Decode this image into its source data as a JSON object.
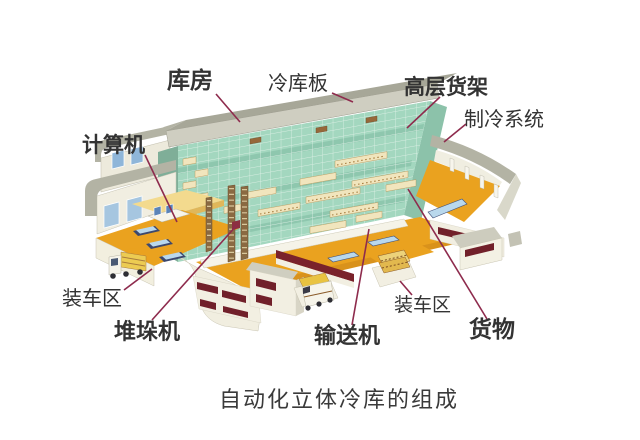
{
  "diagram": {
    "title": "自动化立体冷库的组成",
    "labels": {
      "storeroom": "库房",
      "cold_storage_panel": "冷库板",
      "high_rise_rack": "高层货架",
      "refrigeration_system": "制冷系统",
      "computer": "计算机",
      "loading_area_left": "装车区",
      "loading_area_right": "装车区",
      "stacker_crane": "堆垛机",
      "conveyor": "输送机",
      "goods": "货物"
    },
    "colors": {
      "background": "#ffffff",
      "leader_line": "#8e2b4d",
      "floor_orange": "#eaa21f",
      "rack_green": "#a3d7bf",
      "roof_gray": "#a7a798",
      "wall_cream": "#f1eee1",
      "vent_maroon": "#71202a",
      "label_text": "#333333"
    }
  }
}
